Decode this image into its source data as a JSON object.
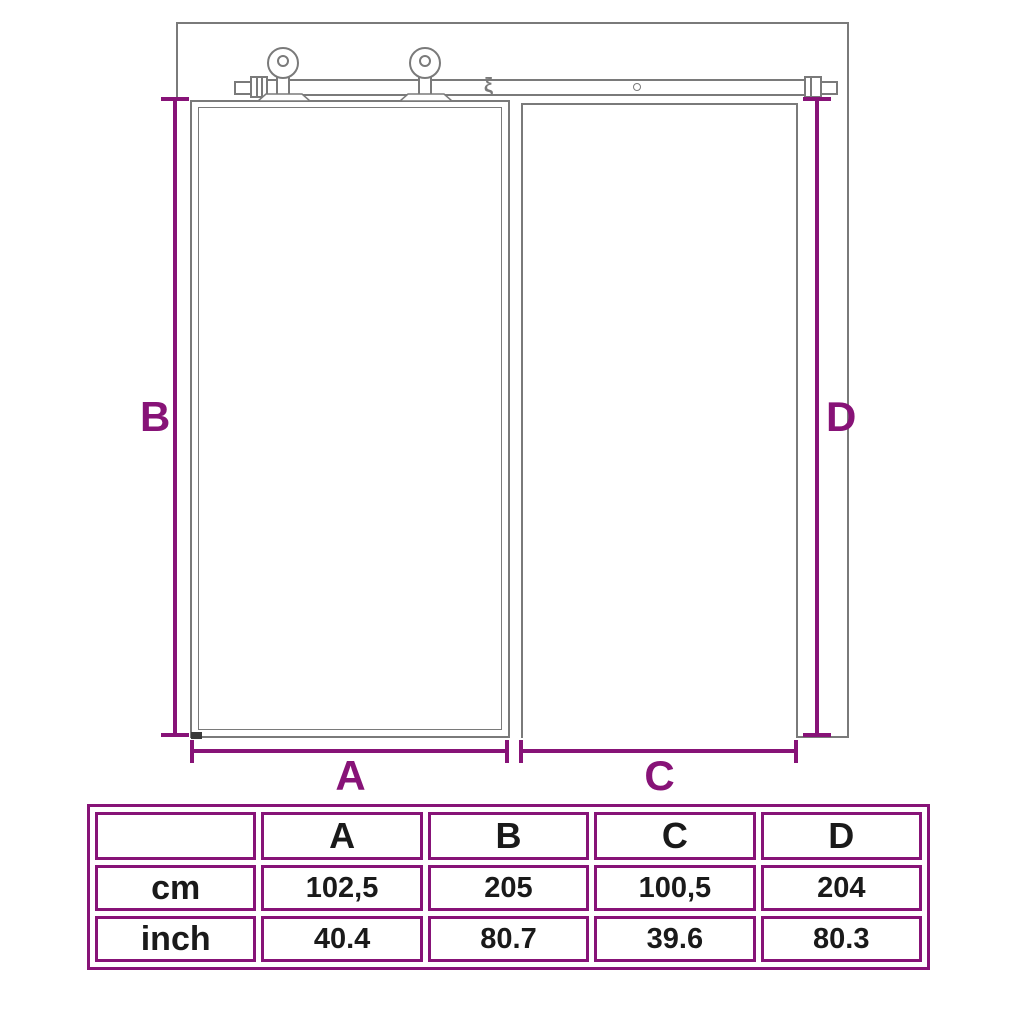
{
  "colors": {
    "accent_purple": "#871377",
    "line_gray": "#7a7a7a",
    "text_black": "#1a1a1a"
  },
  "diagram": {
    "dim_labels": {
      "a": "A",
      "b": "B",
      "c": "C",
      "d": "D"
    },
    "rail_break_symbol": "ξ"
  },
  "table": {
    "columns": [
      "A",
      "B",
      "C",
      "D"
    ],
    "rows": [
      {
        "label": "cm",
        "values": [
          "102,5",
          "205",
          "100,5",
          "204"
        ]
      },
      {
        "label": "inch",
        "values": [
          "40.4",
          "80.7",
          "39.6",
          "80.3"
        ]
      }
    ]
  }
}
